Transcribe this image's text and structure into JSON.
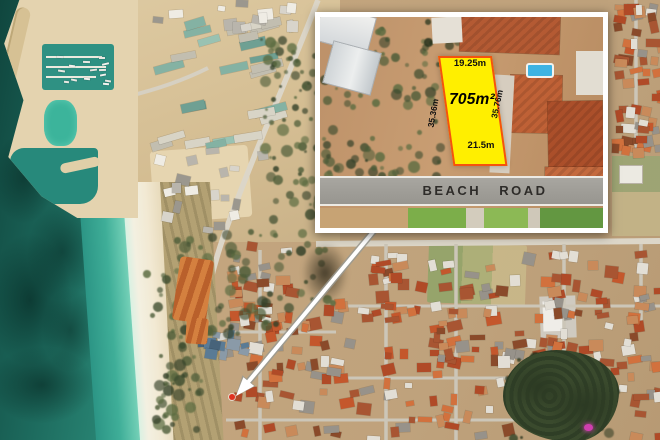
{
  "inset": {
    "road_name": "BEACH ROAD",
    "parcel": {
      "area": "705m²",
      "dim_top": "19.25m",
      "dim_bottom": "21.5m",
      "dim_left": "35.36m",
      "dim_right": "35.76m"
    }
  },
  "colors": {
    "parcel_fill": "#ffef00",
    "parcel_outline": "#f4530e",
    "marker": "#e0311f",
    "arrow": "#ffffff"
  }
}
